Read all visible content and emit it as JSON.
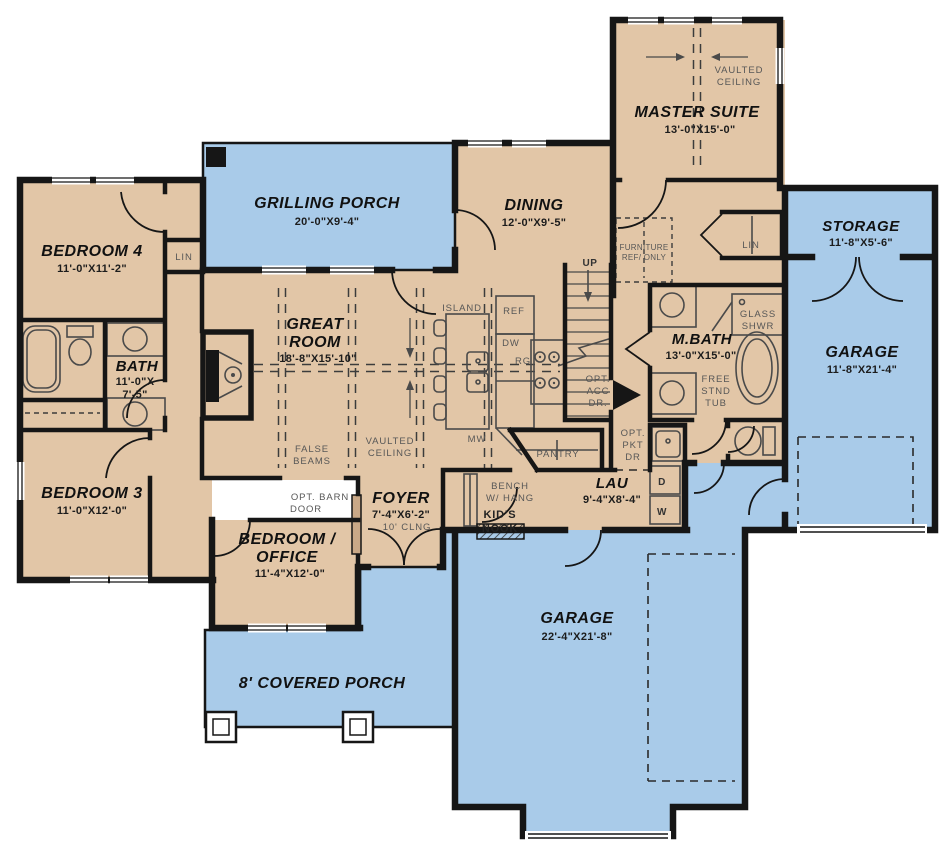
{
  "plan": {
    "colors": {
      "floor": "#e2c6a7",
      "porch_garage": "#a9cbe9",
      "wall": "#161616",
      "small_label": "#575757"
    },
    "rooms": {
      "master_suite": {
        "name": "MASTER SUITE",
        "dims": "13'-0\"X15'-0\""
      },
      "storage": {
        "name": "STORAGE",
        "dims": "11'-8\"X5'-6\""
      },
      "garage_right": {
        "name": "GARAGE",
        "dims": "11'-8\"X21'-4\""
      },
      "garage_main": {
        "name": "GARAGE",
        "dims": "22'-4\"X21'-8\""
      },
      "grilling_porch": {
        "name": "GRILLING PORCH",
        "dims": "20'-0\"X9'-4\""
      },
      "dining": {
        "name": "DINING",
        "dims": "12'-0\"X9'-5\""
      },
      "bedroom4": {
        "name": "BEDROOM 4",
        "dims": "11'-0\"X11'-2\""
      },
      "bath": {
        "name": "BATH",
        "dims1": "11'-0\"X",
        "dims2": "7'-5\""
      },
      "great_room": {
        "name1": "GREAT",
        "name2": "ROOM",
        "dims": "18'-8\"X15'-10\""
      },
      "bedroom3": {
        "name": "BEDROOM 3",
        "dims": "11'-0\"X12'-0\""
      },
      "bedroom_office": {
        "name1": "BEDROOM /",
        "name2": "OFFICE",
        "dims": "11'-4\"X12'-0\""
      },
      "foyer": {
        "name": "FOYER",
        "dims": "7'-4\"X6'-2\"",
        "ceiling": "10' CLNG"
      },
      "m_bath": {
        "name": "M.BATH",
        "dims": "13'-0\"X15'-0\""
      },
      "laundry": {
        "name": "LAU",
        "dims": "9'-4\"X8'-4\""
      },
      "covered_porch": {
        "name": "8' COVERED PORCH"
      }
    },
    "annotations": {
      "vaulted_ceiling": {
        "line1": "VAULTED",
        "line2": "CEILING"
      },
      "false_beams": {
        "line1": "FALSE",
        "line2": "BEAMS"
      },
      "furniture_note": {
        "line1": "FURNITURE",
        "line2": "REF/ ONLY"
      },
      "opt_access_door": {
        "line1": "OPT.",
        "line2": "ACC",
        "line3": "DR."
      },
      "opt_pocket_door": {
        "line1": "OPT.",
        "line2": "PKT",
        "line3": "DR"
      },
      "opt_barn_door": {
        "line1": "OPT. BARN",
        "line2": "DOOR"
      },
      "bench": {
        "line1": "BENCH",
        "line2": "W/ HANG"
      },
      "kids_nook": {
        "line1": "KID'S",
        "line2": "NOOK"
      },
      "glass_shower": {
        "line1": "GLASS",
        "line2": "SHWR"
      },
      "free_tub": {
        "line1": "FREE",
        "line2": "STND",
        "line3": "TUB"
      },
      "up": "UP",
      "linen": "LIN",
      "island": "ISLAND",
      "fridge": "REF",
      "dishwasher": "DW",
      "range": "RG",
      "microwave": "MW",
      "pantry": "PANTRY",
      "washer": "W",
      "dryer": "D"
    }
  }
}
